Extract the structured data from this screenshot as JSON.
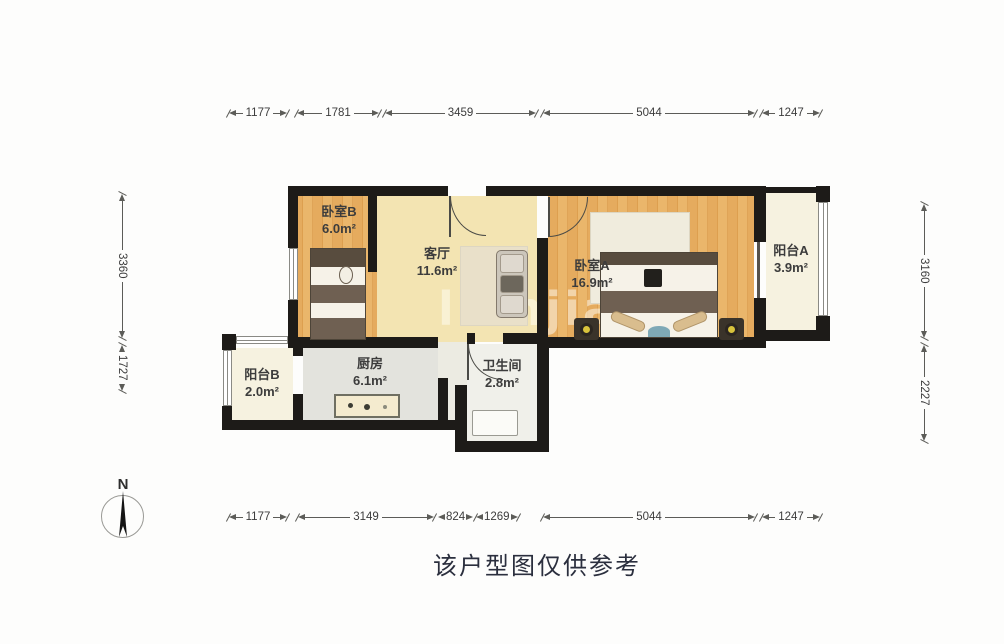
{
  "caption": "该户型图仅供参考",
  "watermark": "lianjia",
  "compass": {
    "north_label": "N"
  },
  "rooms": [
    {
      "id": "bedroom-b",
      "name": "卧室B",
      "area": "6.0m²"
    },
    {
      "id": "living-room",
      "name": "客厅",
      "area": "11.6m²"
    },
    {
      "id": "bedroom-a",
      "name": "卧室A",
      "area": "16.9m²"
    },
    {
      "id": "balcony-a",
      "name": "阳台A",
      "area": "3.9m²"
    },
    {
      "id": "balcony-b",
      "name": "阳台B",
      "area": "2.0m²"
    },
    {
      "id": "kitchen",
      "name": "厨房",
      "area": "6.1m²"
    },
    {
      "id": "bathroom",
      "name": "卫生间",
      "area": "2.8m²"
    }
  ],
  "dimensions": {
    "top": [
      "1177",
      "1781",
      "3459",
      "5044",
      "1247"
    ],
    "bottom": [
      "1177",
      "3149",
      "824",
      "1269",
      "5044",
      "1247"
    ],
    "left": [
      "3360",
      "1727"
    ],
    "right": [
      "3160",
      "2227"
    ]
  },
  "colors": {
    "wall": "#1d1b18",
    "wood_floor": "#e5ab5e",
    "living_floor": "#f3e4b2",
    "kitchen_floor": "#e3e3dd",
    "balcony_floor": "#f6f2e0",
    "dimension_text": "#3c3c3c"
  }
}
